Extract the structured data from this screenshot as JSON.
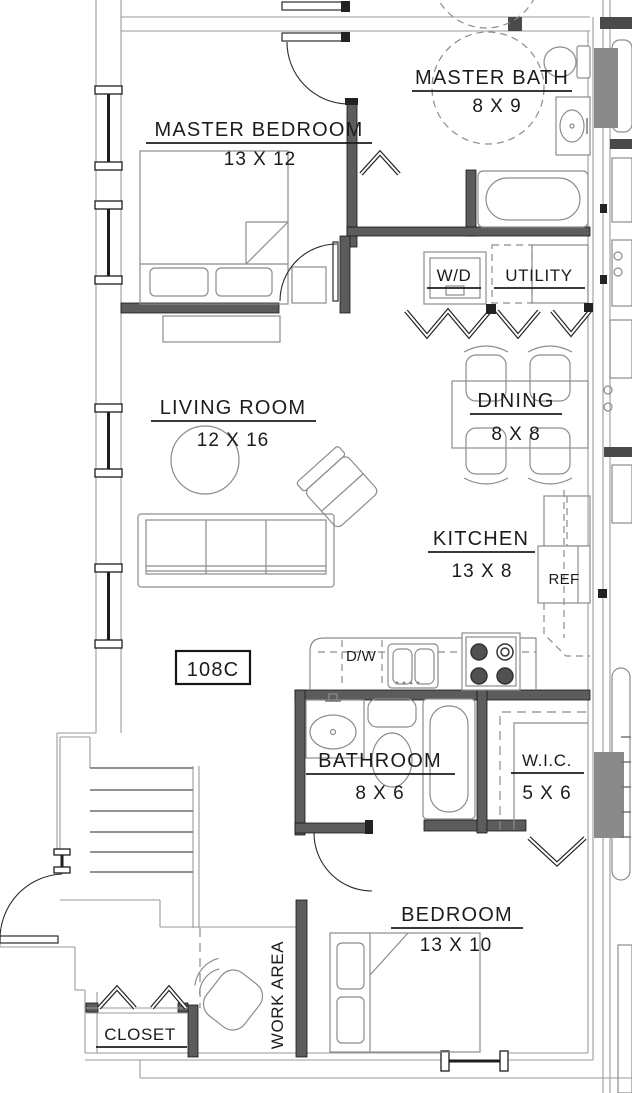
{
  "colors": {
    "background": "#ffffff",
    "line_light": "#9a9a9a",
    "wall_fill": "#5c5c5c",
    "wall_gray": "#8a8a8a",
    "text_color": "#1c1c1c"
  },
  "unit": {
    "number": "108C"
  },
  "rooms": {
    "master_bath": {
      "name": "MASTER BATH",
      "dims": "8 X 9"
    },
    "master_bedroom": {
      "name": "MASTER BEDROOM",
      "dims": "13 X 12"
    },
    "utility": {
      "name": "UTILITY"
    },
    "living_room": {
      "name": "LIVING ROOM",
      "dims": "12 X 16"
    },
    "dining": {
      "name": "DINING",
      "dims": "8 X 8"
    },
    "kitchen": {
      "name": "KITCHEN",
      "dims": "13 X 8"
    },
    "bathroom": {
      "name": "BATHROOM",
      "dims": "8 X 6"
    },
    "wic": {
      "name": "W.I.C.",
      "dims": "5 X 6"
    },
    "bedroom": {
      "name": "BEDROOM",
      "dims": "13 X 10"
    },
    "closet": {
      "name": "CLOSET"
    },
    "work_area": {
      "name": "WORK AREA"
    }
  },
  "appliances": {
    "washer_dryer": "W/D",
    "refrigerator": "REF",
    "dishwasher": "D/W"
  }
}
